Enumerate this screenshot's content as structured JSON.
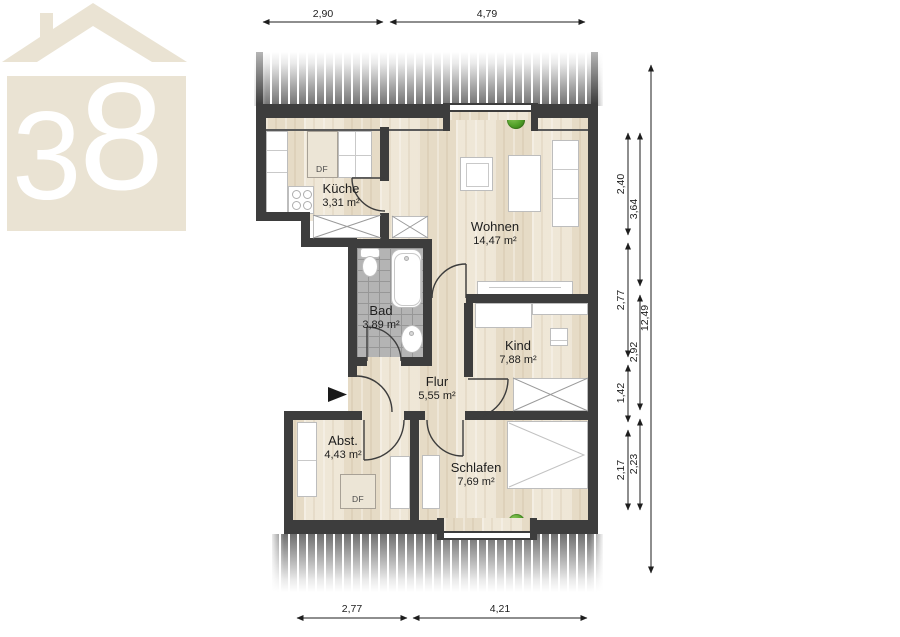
{
  "logo": {
    "digit_left": "3",
    "digit_right": "8"
  },
  "rooms": {
    "kueche": {
      "name": "Küche",
      "area": "3,31 m²"
    },
    "wohnen": {
      "name": "Wohnen",
      "area": "14,47 m²"
    },
    "bad": {
      "name": "Bad",
      "area": "3,89 m²"
    },
    "flur": {
      "name": "Flur",
      "area": "5,55 m²"
    },
    "kind": {
      "name": "Kind",
      "area": "7,88 m²"
    },
    "abst": {
      "name": "Abst.",
      "area": "4,43 m²"
    },
    "schlafen": {
      "name": "Schlafen",
      "area": "7,69 m²"
    }
  },
  "annotations": {
    "skylight": "DF"
  },
  "dimensions": {
    "top": {
      "d1": "2,90",
      "d2": "4,79"
    },
    "bottom": {
      "d1": "2,77",
      "d2": "4,21"
    },
    "right_col1": {
      "d1": "2,40",
      "d2": "2,77",
      "d3": "1,42",
      "d4": "2,17"
    },
    "right_col2": {
      "d1": "3,64",
      "d2": "2,92",
      "d3": "2,23"
    },
    "right_total": "12,49"
  },
  "colors": {
    "wall": "#3d3d3d",
    "floor": "#ece3d1",
    "tile": "#b4b4b4",
    "logo_beige": "#eae3d3",
    "plant_green": "#4f9e27"
  }
}
